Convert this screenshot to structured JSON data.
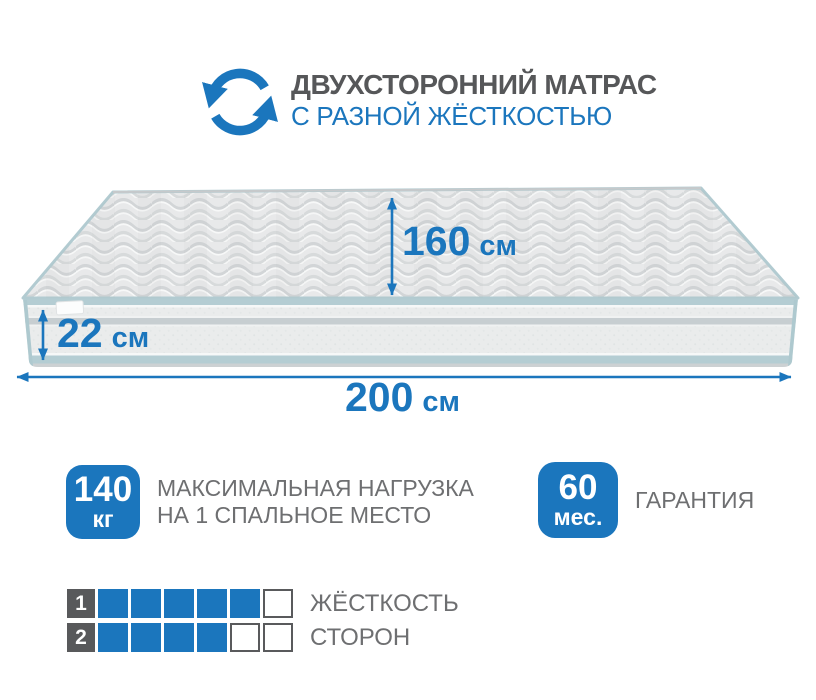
{
  "colors": {
    "accent_blue": "#1b76bd",
    "title_gray": "#565759",
    "text_gray": "#6e6f71",
    "piping_teal": "#b4cdd3",
    "row_index_gray": "#58595b"
  },
  "icons": {
    "header": "rotate-arrows-icon"
  },
  "header": {
    "title": "ДВУХСТОРОННИЙ МАТРАС",
    "subtitle": "С РАЗНОЙ ЖЁСТКОСТЬЮ"
  },
  "dimensions": {
    "length": {
      "value": "160",
      "unit": "см"
    },
    "height": {
      "value": "22",
      "unit": "см"
    },
    "width": {
      "value": "200",
      "unit": "см"
    }
  },
  "badges": {
    "max_load": {
      "value": "140",
      "unit": "кг",
      "line1": "МАКСИМАЛЬНАЯ НАГРУЗКА",
      "line2": "НА 1 СПАЛЬНОЕ МЕСТО"
    },
    "warranty": {
      "value": "60",
      "unit": "мес.",
      "label": "ГАРАНТИЯ"
    }
  },
  "firmness": {
    "rows": [
      {
        "index": "1",
        "label": "ЖЁСТКОСТЬ",
        "cells": [
          "filled",
          "filled",
          "filled",
          "filled",
          "filled",
          "empty"
        ]
      },
      {
        "index": "2",
        "label": "СТОРОН",
        "cells": [
          "filled",
          "filled",
          "filled",
          "filled",
          "empty",
          "empty"
        ]
      }
    ]
  }
}
